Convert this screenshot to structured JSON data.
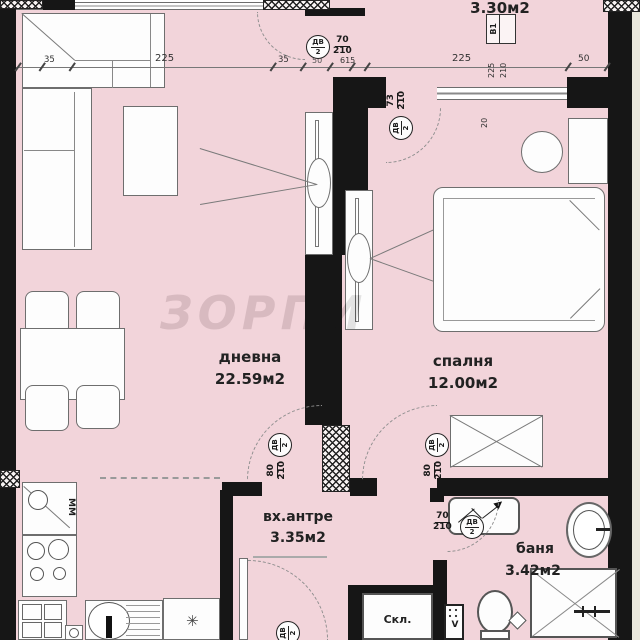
{
  "rooms": {
    "living": {
      "name": "дневна",
      "area": "22.59м2"
    },
    "bedroom": {
      "name": "спалня",
      "area": "12.00м2"
    },
    "hall": {
      "name": "вх.антре",
      "area": "3.35м2"
    },
    "bath": {
      "name": "баня",
      "area": "3.42м2"
    },
    "balcony": {
      "area": "3.30м2"
    },
    "closet": {
      "name": "Скл."
    }
  },
  "markers": {
    "door_code": "ДВ",
    "door_num": "2",
    "window_code": "В1",
    "window_w": "225",
    "window_h": "210"
  },
  "sizes": {
    "s70": "70",
    "s73": "73",
    "s80": "80",
    "s210": "210"
  },
  "dims": {
    "a": "35",
    "b": "225",
    "c": "35",
    "d": "50",
    "e": "615",
    "f": "225",
    "g": "50",
    "depth": "20"
  },
  "kitchen": {
    "mm": "ММ",
    "star": "✳"
  },
  "vent": {
    "label": "V"
  },
  "watermark": {
    "text": "ЗОРПИ"
  }
}
